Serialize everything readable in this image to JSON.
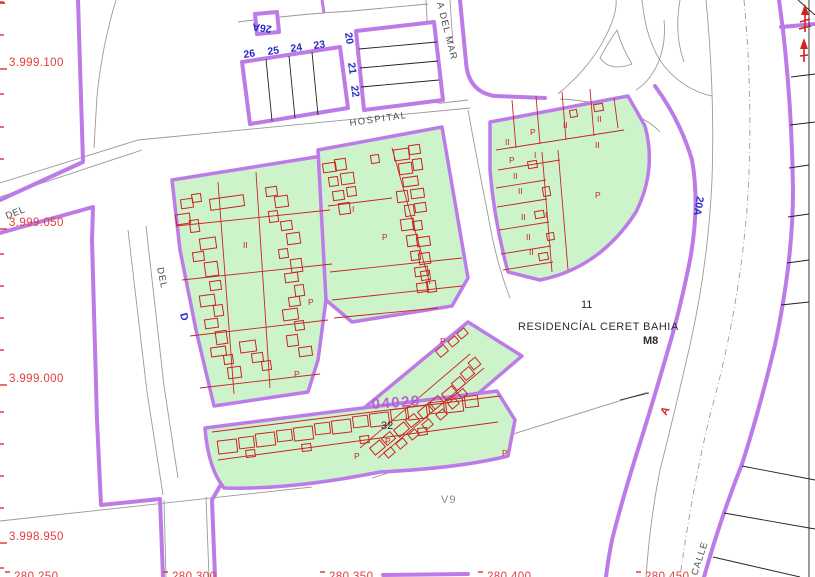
{
  "map_type": "cadastral-parcel-map",
  "colors": {
    "street_outline": "#bc7be6",
    "block_fill_green": "#cdf3cb",
    "building_red": "#cc2323",
    "coordinate_red": "#e23d3d",
    "parcel_number_blue": "#2a2ac8",
    "road_gray": "#9a9a9a",
    "reference_purple": "#b55bd6",
    "background": "#ffffff"
  },
  "axis": {
    "y_ticks": [
      2,
      35,
      94,
      127,
      159,
      254,
      286,
      318,
      350,
      412,
      444,
      476,
      508,
      568
    ],
    "y_label_ticks": [
      69,
      229,
      385,
      543
    ],
    "x_label_ticks": [
      5,
      163,
      320,
      478,
      636
    ]
  },
  "labels": [
    {
      "text": "3.999.100",
      "x": 9,
      "y": 66,
      "cls": "axisred",
      "name": "y-axis-label-3999100"
    },
    {
      "text": "3.999.050",
      "x": 9,
      "y": 226,
      "cls": "axisred",
      "name": "y-axis-label-3999050"
    },
    {
      "text": "3.999.000",
      "x": 9,
      "y": 382,
      "cls": "axisred",
      "name": "y-axis-label-3999000"
    },
    {
      "text": "3.998.950",
      "x": 9,
      "y": 540,
      "cls": "axisred",
      "name": "y-axis-label-3998950"
    },
    {
      "text": "280.250",
      "x": 14,
      "y": 580,
      "cls": "axisred",
      "name": "x-axis-label-280250"
    },
    {
      "text": "280.300",
      "x": 172,
      "y": 580,
      "cls": "axisred",
      "name": "x-axis-label-280300"
    },
    {
      "text": "280.350",
      "x": 329,
      "y": 580,
      "cls": "axisred",
      "name": "x-axis-label-280350"
    },
    {
      "text": "280.400",
      "x": 487,
      "y": 580,
      "cls": "axisred",
      "name": "x-axis-label-280400"
    },
    {
      "text": "280.450",
      "x": 645,
      "y": 580,
      "cls": "axisred",
      "name": "x-axis-label-280450"
    },
    {
      "text": "HOSPITAL",
      "x": 350,
      "y": 126,
      "rot": -8,
      "cls": "street",
      "ls": 1.5,
      "name": "hospital-street-label"
    },
    {
      "text": "A DEL MAR",
      "x": 437,
      "y": 3,
      "rot": 76,
      "cls": "street",
      "ls": 1,
      "name": "del-mar-street-label"
    },
    {
      "text": "DEL",
      "x": 157,
      "y": 268,
      "rot": 78,
      "cls": "street",
      "ls": 1,
      "name": "del-street-label"
    },
    {
      "text": "DEL",
      "x": 7,
      "y": 219,
      "rot": -21,
      "cls": "street",
      "ls": 0.5,
      "name": "del-street-label-2"
    },
    {
      "text": "CALLE",
      "x": 697,
      "y": 576,
      "rot": -72,
      "cls": "street",
      "ls": 1,
      "name": "calle-street-label"
    },
    {
      "text": "V9",
      "x": 441,
      "y": 503,
      "cls": "v9",
      "name": "v9-parcel-label"
    },
    {
      "text": "11",
      "x": 581,
      "y": 308,
      "cls": "black",
      "name": "parcel-11-label"
    },
    {
      "text": "RESIDENCÍAL CERET BAHIA",
      "x": 518,
      "y": 330,
      "cls": "black",
      "size": 12,
      "ls": 0.5,
      "name": "residencial-ceret-bahia-label"
    },
    {
      "text": "M8",
      "x": 643,
      "y": 344,
      "cls": "black bold",
      "size": 7.5,
      "name": "m8-label"
    },
    {
      "text": "32",
      "x": 381,
      "y": 429,
      "cls": "black",
      "size": 14,
      "name": "parcel-32-label"
    },
    {
      "text": "04029",
      "x": 372,
      "y": 409,
      "rot": -4,
      "cls": "purpleref",
      "name": "parcel-ref-04029"
    },
    {
      "text": "26",
      "x": 244,
      "y": 58,
      "rot": -8,
      "cls": "blue",
      "name": "parcel-26-label"
    },
    {
      "text": "25",
      "x": 268,
      "y": 55,
      "rot": -8,
      "cls": "blue",
      "name": "parcel-25-label"
    },
    {
      "text": "24",
      "x": 291,
      "y": 52,
      "rot": -8,
      "cls": "blue",
      "name": "parcel-24-label"
    },
    {
      "text": "23",
      "x": 314,
      "y": 49,
      "rot": -8,
      "cls": "blue",
      "name": "parcel-23-label"
    },
    {
      "text": "20",
      "x": 345,
      "y": 33,
      "rot": 82,
      "cls": "blue",
      "name": "parcel-20-label"
    },
    {
      "text": "21",
      "x": 348,
      "y": 63,
      "rot": 82,
      "cls": "blue",
      "name": "parcel-21-label"
    },
    {
      "text": "22",
      "x": 351,
      "y": 86,
      "rot": 82,
      "cls": "blue",
      "name": "parcel-22-label"
    },
    {
      "text": "26A",
      "x": 272,
      "y": 26,
      "rot": 188,
      "cls": "blue",
      "name": "parcel-26a-label"
    },
    {
      "text": "20A",
      "x": 697,
      "y": 196,
      "rot": 100,
      "cls": "blue",
      "name": "road-20a-label"
    },
    {
      "text": "D",
      "x": 180,
      "y": 314,
      "rot": 75,
      "cls": "blue",
      "size": 8,
      "name": "blue-d-mark"
    },
    {
      "text": "A",
      "x": 666,
      "y": 416,
      "rot": -60,
      "cls": "redA",
      "name": "road-a-label"
    },
    {
      "text": "P",
      "x": 308,
      "y": 305,
      "cls": "redp",
      "name": "p-label"
    },
    {
      "text": "P",
      "x": 294,
      "y": 377,
      "cls": "redp",
      "name": "p-label"
    },
    {
      "text": "P",
      "x": 382,
      "y": 240,
      "cls": "redp",
      "name": "p-label"
    },
    {
      "text": "I",
      "x": 352,
      "y": 212,
      "cls": "redp",
      "name": "floor-label"
    },
    {
      "text": "II",
      "x": 243,
      "y": 248,
      "cls": "redp",
      "name": "floor-label"
    },
    {
      "text": "II",
      "x": 505,
      "y": 145,
      "cls": "redp",
      "name": "floor-label"
    },
    {
      "text": "P",
      "x": 530,
      "y": 135,
      "cls": "redp",
      "name": "p-label"
    },
    {
      "text": "II",
      "x": 563,
      "y": 128,
      "cls": "redp",
      "name": "floor-label"
    },
    {
      "text": "II",
      "x": 597,
      "y": 122,
      "cls": "redp",
      "name": "floor-label"
    },
    {
      "text": "II",
      "x": 595,
      "y": 148,
      "cls": "redp",
      "name": "floor-label"
    },
    {
      "text": "P",
      "x": 509,
      "y": 163,
      "cls": "redp",
      "name": "p-label"
    },
    {
      "text": "I",
      "x": 534,
      "y": 158,
      "cls": "redp",
      "name": "floor-label"
    },
    {
      "text": "II",
      "x": 513,
      "y": 179,
      "cls": "redp",
      "name": "floor-label"
    },
    {
      "text": "II",
      "x": 518,
      "y": 194,
      "cls": "redp",
      "name": "floor-label"
    },
    {
      "text": "II",
      "x": 521,
      "y": 220,
      "cls": "redp",
      "name": "floor-label"
    },
    {
      "text": "I",
      "x": 545,
      "y": 218,
      "cls": "redp",
      "name": "floor-label"
    },
    {
      "text": "II",
      "x": 526,
      "y": 240,
      "cls": "redp",
      "name": "floor-label"
    },
    {
      "text": "II",
      "x": 529,
      "y": 255,
      "cls": "redp",
      "name": "floor-label"
    },
    {
      "text": "P",
      "x": 595,
      "y": 198,
      "cls": "redp",
      "size": 10,
      "name": "p-label"
    },
    {
      "text": "P",
      "x": 440,
      "y": 344,
      "cls": "redp",
      "name": "p-label"
    },
    {
      "text": "P",
      "x": 385,
      "y": 444,
      "cls": "redp",
      "name": "p-label"
    },
    {
      "text": "P",
      "x": 354,
      "y": 459,
      "cls": "redp",
      "name": "p-label"
    },
    {
      "text": "P",
      "x": 502,
      "y": 456,
      "cls": "redp",
      "name": "p-label"
    }
  ],
  "buildings": {
    "blockA": [
      [
        210,
        197,
        34,
        11
      ],
      [
        181,
        199,
        12,
        9
      ],
      [
        192,
        194,
        9,
        8
      ],
      [
        176,
        214,
        14,
        10
      ],
      [
        190,
        220,
        9,
        12
      ],
      [
        200,
        238,
        16,
        11
      ],
      [
        193,
        252,
        11,
        9
      ],
      [
        205,
        262,
        13,
        14
      ],
      [
        210,
        281,
        11,
        9
      ],
      [
        200,
        295,
        15,
        11
      ],
      [
        214,
        305,
        9,
        11
      ],
      [
        205,
        319,
        13,
        9
      ],
      [
        216,
        331,
        11,
        13
      ],
      [
        211,
        347,
        15,
        9
      ],
      [
        224,
        355,
        9,
        9
      ],
      [
        228,
        367,
        13,
        11
      ],
      [
        240,
        341,
        16,
        11
      ],
      [
        252,
        353,
        11,
        9
      ],
      [
        262,
        361,
        9,
        9
      ],
      [
        266,
        187,
        11,
        9
      ],
      [
        275,
        196,
        13,
        11
      ],
      [
        269,
        211,
        9,
        11
      ],
      [
        281,
        221,
        11,
        9
      ],
      [
        287,
        233,
        13,
        11
      ],
      [
        279,
        249,
        9,
        9
      ],
      [
        291,
        259,
        11,
        13
      ],
      [
        285,
        273,
        13,
        9
      ],
      [
        295,
        285,
        9,
        11
      ],
      [
        289,
        297,
        11,
        9
      ],
      [
        283,
        309,
        15,
        11
      ],
      [
        295,
        321,
        9,
        9
      ],
      [
        287,
        335,
        11,
        11
      ],
      [
        299,
        347,
        13,
        9
      ]
    ],
    "blockB": [
      [
        323,
        163,
        13,
        9
      ],
      [
        335,
        159,
        11,
        11
      ],
      [
        329,
        177,
        9,
        9
      ],
      [
        341,
        173,
        13,
        11
      ],
      [
        333,
        191,
        11,
        9
      ],
      [
        347,
        187,
        9,
        9
      ],
      [
        339,
        203,
        11,
        11
      ],
      [
        394,
        149,
        15,
        11
      ],
      [
        409,
        145,
        11,
        9
      ],
      [
        399,
        163,
        13,
        11
      ],
      [
        413,
        159,
        9,
        11
      ],
      [
        403,
        177,
        15,
        9
      ],
      [
        397,
        191,
        11,
        11
      ],
      [
        411,
        189,
        13,
        9
      ],
      [
        405,
        205,
        9,
        11
      ],
      [
        415,
        203,
        11,
        9
      ],
      [
        401,
        219,
        13,
        11
      ],
      [
        413,
        221,
        9,
        9
      ],
      [
        407,
        235,
        11,
        11
      ],
      [
        417,
        237,
        13,
        9
      ],
      [
        411,
        251,
        9,
        9
      ],
      [
        419,
        253,
        11,
        11
      ],
      [
        415,
        267,
        13,
        9
      ],
      [
        421,
        271,
        9,
        9
      ],
      [
        417,
        283,
        11,
        9
      ],
      [
        427,
        281,
        9,
        11
      ],
      [
        371,
        155,
        8,
        8
      ]
    ],
    "blockC": [
      [
        528,
        161,
        9,
        7
      ],
      [
        543,
        187,
        7,
        9
      ],
      [
        535,
        211,
        9,
        7
      ],
      [
        547,
        233,
        7,
        7
      ],
      [
        539,
        253,
        9,
        7
      ],
      [
        594,
        104,
        9,
        7
      ],
      [
        570,
        110,
        7,
        7
      ]
    ],
    "blockD": [
      [
        371,
        443,
        13,
        9
      ],
      [
        383,
        434,
        11,
        9
      ],
      [
        395,
        425,
        13,
        9
      ],
      [
        407,
        416,
        11,
        9
      ],
      [
        419,
        407,
        13,
        9
      ],
      [
        431,
        398,
        11,
        9
      ],
      [
        443,
        389,
        13,
        9
      ],
      [
        453,
        379,
        11,
        9
      ],
      [
        462,
        369,
        11,
        9
      ],
      [
        470,
        359,
        9,
        9
      ],
      [
        385,
        449,
        9,
        7
      ],
      [
        397,
        440,
        9,
        7
      ],
      [
        409,
        431,
        9,
        7
      ],
      [
        423,
        421,
        9,
        7
      ],
      [
        437,
        411,
        9,
        7
      ],
      [
        449,
        400,
        9,
        7
      ],
      [
        459,
        390,
        7,
        7
      ],
      [
        437,
        347,
        10,
        8
      ],
      [
        449,
        338,
        9,
        7
      ],
      [
        458,
        330,
        9,
        7
      ]
    ],
    "blockE": [
      [
        218,
        440,
        19,
        13
      ],
      [
        239,
        437,
        15,
        11
      ],
      [
        256,
        433,
        19,
        13
      ],
      [
        277,
        430,
        15,
        11
      ],
      [
        294,
        427,
        19,
        13
      ],
      [
        315,
        423,
        15,
        11
      ],
      [
        332,
        420,
        19,
        13
      ],
      [
        353,
        416,
        15,
        11
      ],
      [
        370,
        413,
        19,
        13
      ],
      [
        391,
        409,
        15,
        11
      ],
      [
        408,
        406,
        19,
        13
      ],
      [
        429,
        402,
        15,
        11
      ],
      [
        446,
        399,
        17,
        13
      ],
      [
        465,
        396,
        13,
        11
      ],
      [
        246,
        450,
        9,
        7
      ],
      [
        302,
        444,
        9,
        7
      ],
      [
        360,
        436,
        9,
        7
      ],
      [
        418,
        428,
        9,
        7
      ]
    ]
  },
  "red_lines": [
    [
      176,
      226,
      330,
      210
    ],
    [
      182,
      280,
      332,
      264
    ],
    [
      190,
      336,
      328,
      320
    ],
    [
      200,
      388,
      320,
      374
    ],
    [
      256,
      172,
      270,
      388
    ],
    [
      218,
      182,
      234,
      394
    ],
    [
      330,
      272,
      462,
      258
    ],
    [
      332,
      300,
      462,
      286
    ],
    [
      334,
      318,
      438,
      308
    ],
    [
      392,
      148,
      430,
      284
    ],
    [
      328,
      206,
      392,
      198
    ],
    [
      512,
      100,
      516,
      148
    ],
    [
      536,
      96,
      540,
      144
    ],
    [
      562,
      92,
      566,
      140
    ],
    [
      590,
      89,
      594,
      136
    ],
    [
      614,
      98,
      618,
      128
    ],
    [
      496,
      150,
      624,
      130
    ],
    [
      498,
      170,
      560,
      160
    ],
    [
      496,
      188,
      546,
      180
    ],
    [
      497,
      207,
      547,
      199
    ],
    [
      499,
      230,
      549,
      222
    ],
    [
      501,
      254,
      551,
      246
    ],
    [
      503,
      270,
      553,
      262
    ],
    [
      542,
      152,
      552,
      272
    ],
    [
      558,
      150,
      568,
      270
    ],
    [
      360,
      448,
      470,
      354
    ],
    [
      378,
      458,
      484,
      368
    ],
    [
      212,
      432,
      500,
      396
    ],
    [
      218,
      460,
      498,
      422
    ]
  ]
}
